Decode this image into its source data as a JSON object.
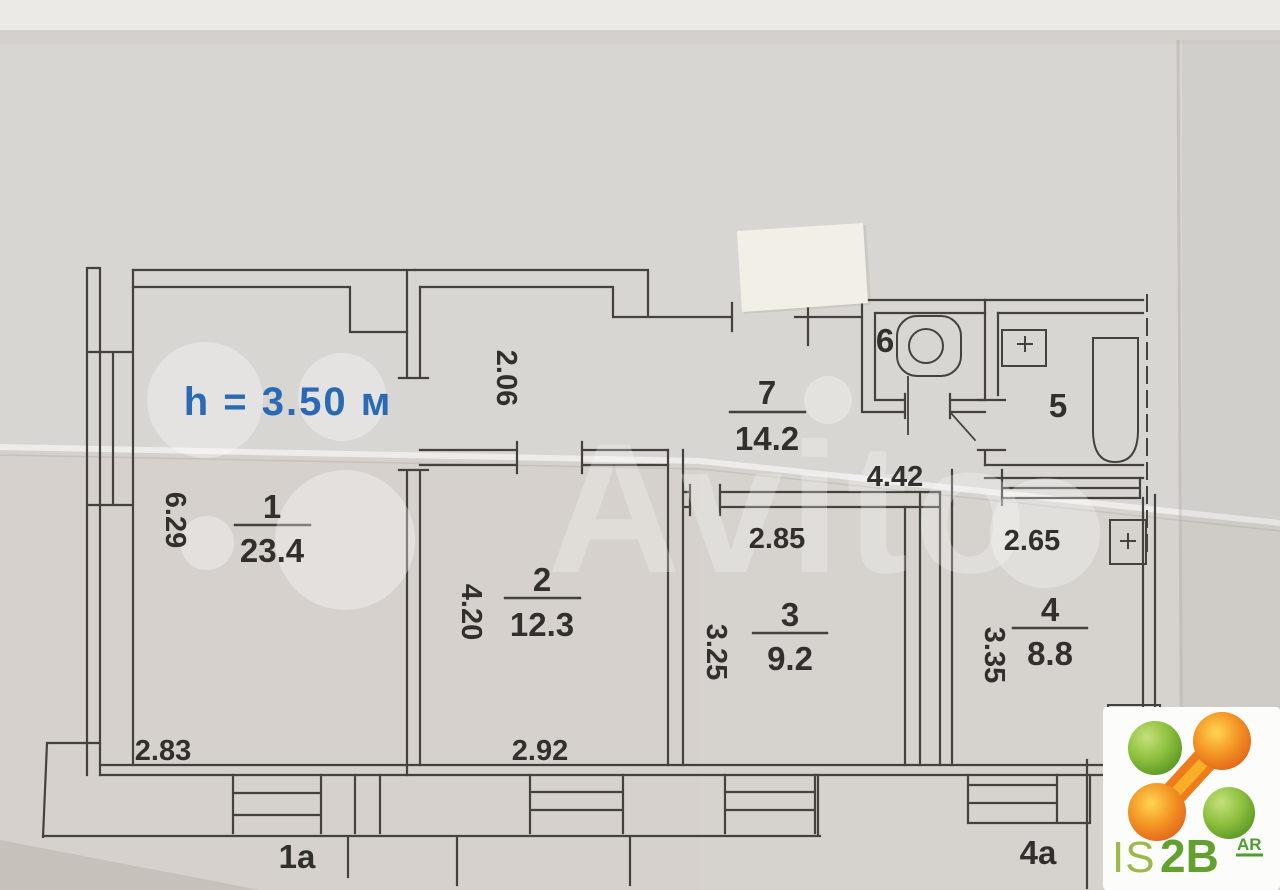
{
  "plan": {
    "ceiling_height": "h = 3.50 м",
    "watermark": "Avito",
    "rooms": {
      "r1": {
        "number": "1",
        "area": "23.4"
      },
      "r2": {
        "number": "2",
        "area": "12.3"
      },
      "r3": {
        "number": "3",
        "area": "9.2"
      },
      "r4": {
        "number": "4",
        "area": "8.8"
      },
      "r5": {
        "number": "5"
      },
      "r6": {
        "number": "6"
      },
      "r7": {
        "number": "7",
        "area": "14.2"
      }
    },
    "dims": {
      "room1_height": "6.29",
      "room1_bottom": "2.83",
      "hall_width": "2.06",
      "room2_height": "4.20",
      "room2_bottom": "2.92",
      "room3_top": "2.85",
      "room3_height": "3.25",
      "corridor_length": "4.42",
      "room4_top": "2.65",
      "room4_height": "3.35"
    },
    "balconies": {
      "b1": "1a",
      "b4": "4a"
    }
  },
  "logo": {
    "is": "IS",
    "two_b": "2B",
    "sup": "AR"
  },
  "colors": {
    "paper": "#d8d6d2",
    "ink": "#44423d",
    "height_blue": "#2a6ab4",
    "logo_green": "#6aa829",
    "logo_orange": "#ef7d1a"
  }
}
